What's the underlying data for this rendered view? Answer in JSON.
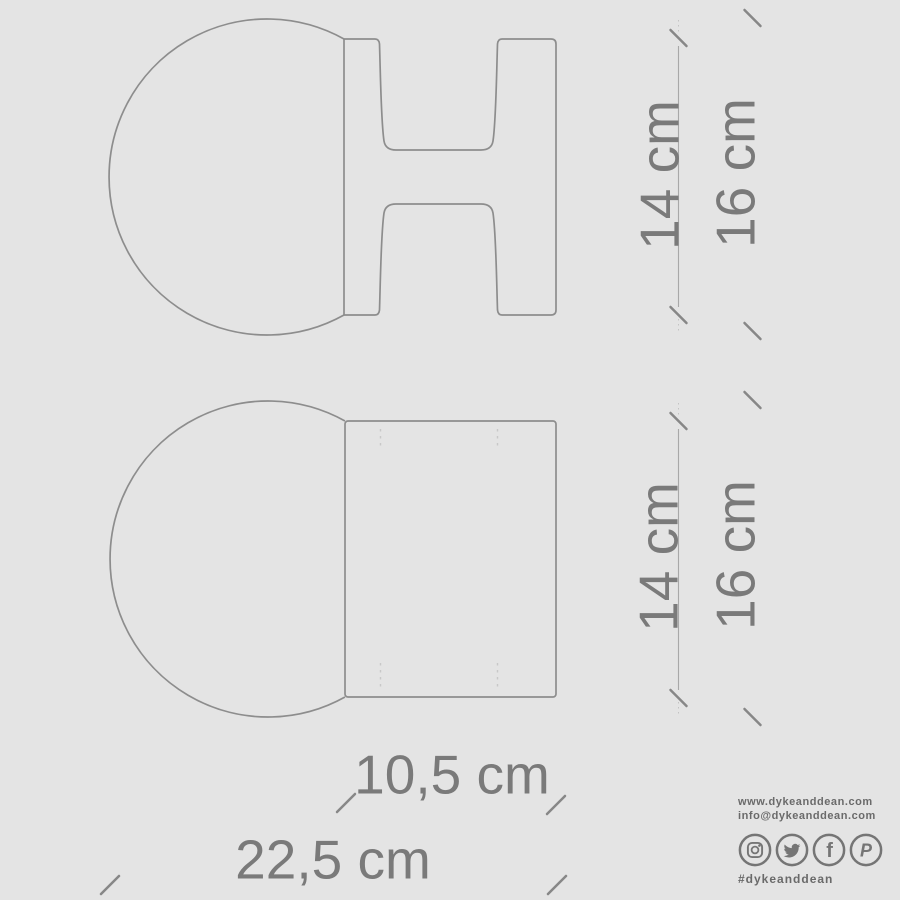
{
  "canvas": {
    "background": "#e4e4e4",
    "line_color": "#8d8d8d",
    "dim_text_color": "#7a7a7a",
    "brand_text_color": "#6a6a6a"
  },
  "dimensions": {
    "upper_drawing": {
      "inner_height": "14 cm",
      "outer_height": "16 cm"
    },
    "lower_drawing": {
      "inner_height": "14 cm",
      "outer_height": "16 cm"
    },
    "width_body": "10,5 cm",
    "width_total": "22,5 cm"
  },
  "branding": {
    "website": "www.dykeanddean.com",
    "email": "info@dykeanddean.com",
    "hashtag": "#dykeanddean",
    "social": [
      {
        "name": "instagram"
      },
      {
        "name": "twitter"
      },
      {
        "name": "facebook",
        "glyph": "f"
      },
      {
        "name": "pinterest",
        "glyph": "P"
      }
    ]
  }
}
